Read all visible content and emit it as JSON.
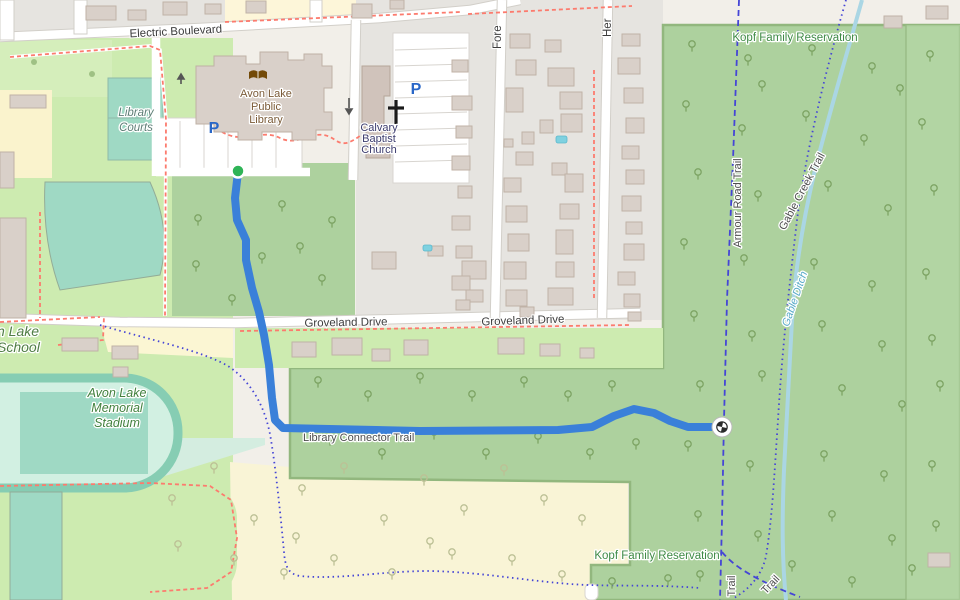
{
  "map": {
    "type": "openstreetmap-style trail route view",
    "labels": {
      "electric_boulevard": "Electric Boulevard",
      "fore_street": "Fore",
      "her_street": "Her",
      "kopf_reservation_top": "Kopf Family Reservation",
      "kopf_reservation_bottom": "Kopf Family Reservation",
      "library": [
        "Avon Lake",
        "Public",
        "Library"
      ],
      "church": [
        "Calvary",
        "Baptist",
        "Church"
      ],
      "groveland_west": "Groveland Drive",
      "groveland_east": "Groveland Drive",
      "school": [
        "n Lake",
        "School"
      ],
      "stadium": [
        "Avon Lake",
        "Memorial",
        "Stadium"
      ],
      "library_courts": [
        "Library",
        "Courts"
      ],
      "library_connector_trail": "Library Connector Trail",
      "armour_road_trail": "Armour Road Trail",
      "gable_creek_trail": "Gable Creek Trail",
      "gable_ditch": "Gable Ditch",
      "trail_vertical": "Trail",
      "trail_diagonal": "Trail",
      "parking_glyph": "P"
    },
    "colors": {
      "route": "#3a80d9",
      "route_start_marker": "#2fb457",
      "trail_blue": "#4545d6",
      "forest_green": "#add19e",
      "grass_green": "#cdebb0",
      "pitch_teal": "#9fd9c4",
      "scrub_yellow": "#f9f4d6",
      "water_blue": "#aad6e4",
      "residential_gray": "#e6e4e0",
      "building_tan": "#d9d0c9",
      "path_red": "#fc7b6e"
    }
  },
  "route": {
    "name": "Library Connector Trail route",
    "color": "#3a80d9",
    "points": [
      [
        238,
        172
      ],
      [
        235,
        198
      ],
      [
        237,
        220
      ],
      [
        246,
        240
      ],
      [
        246,
        260
      ],
      [
        252,
        288
      ],
      [
        259,
        312
      ],
      [
        264,
        335
      ],
      [
        269,
        365
      ],
      [
        272,
        398
      ],
      [
        275,
        420
      ],
      [
        283,
        428
      ],
      [
        420,
        431
      ],
      [
        558,
        430
      ],
      [
        592,
        427
      ],
      [
        614,
        416
      ],
      [
        634,
        409
      ],
      [
        654,
        413
      ],
      [
        670,
        421
      ],
      [
        688,
        427
      ],
      [
        722,
        427
      ]
    ],
    "start": {
      "x": 238,
      "y": 171,
      "icon": "green-dot-start-marker"
    },
    "end": {
      "x": 722,
      "y": 427,
      "icon": "checkered-finish-marker"
    }
  },
  "decor": {
    "houses": [
      [
        86,
        6,
        30,
        14
      ],
      [
        128,
        10,
        18,
        10
      ],
      [
        163,
        2,
        24,
        13
      ],
      [
        205,
        4,
        16,
        10
      ],
      [
        246,
        1,
        20,
        12
      ],
      [
        352,
        4,
        20,
        14
      ],
      [
        390,
        0,
        14,
        9
      ],
      [
        884,
        16,
        18,
        12
      ],
      [
        926,
        6,
        22,
        13
      ],
      [
        928,
        553,
        22,
        14
      ],
      [
        0,
        218,
        26,
        100
      ],
      [
        10,
        95,
        36,
        13
      ],
      [
        0,
        152,
        14,
        36
      ],
      [
        62,
        338,
        36,
        13
      ],
      [
        112,
        346,
        26,
        13
      ],
      [
        113,
        367,
        15,
        10
      ],
      [
        292,
        342,
        24,
        15
      ],
      [
        332,
        338,
        30,
        17
      ],
      [
        372,
        349,
        18,
        12
      ],
      [
        404,
        340,
        24,
        15
      ],
      [
        498,
        338,
        26,
        16
      ],
      [
        540,
        344,
        20,
        12
      ],
      [
        580,
        348,
        14,
        10
      ],
      [
        372,
        252,
        24,
        17
      ],
      [
        428,
        246,
        15,
        10
      ],
      [
        462,
        261,
        24,
        18
      ],
      [
        466,
        290,
        17,
        12
      ],
      [
        452,
        60,
        16,
        12
      ],
      [
        452,
        96,
        20,
        14
      ],
      [
        456,
        126,
        16,
        12
      ],
      [
        452,
        156,
        18,
        14
      ],
      [
        458,
        186,
        14,
        12
      ],
      [
        452,
        216,
        18,
        14
      ],
      [
        456,
        246,
        16,
        12
      ],
      [
        452,
        276,
        18,
        14
      ],
      [
        456,
        300,
        14,
        10
      ],
      [
        510,
        34,
        20,
        14
      ],
      [
        545,
        40,
        16,
        12
      ],
      [
        516,
        60,
        20,
        15
      ],
      [
        548,
        68,
        26,
        18
      ],
      [
        506,
        88,
        17,
        24
      ],
      [
        560,
        92,
        22,
        17
      ],
      [
        561,
        114,
        21,
        18
      ],
      [
        540,
        120,
        13,
        13
      ],
      [
        522,
        132,
        12,
        12
      ],
      [
        504,
        139,
        9,
        8
      ],
      [
        516,
        152,
        17,
        13
      ],
      [
        552,
        163,
        15,
        12
      ],
      [
        504,
        178,
        17,
        14
      ],
      [
        565,
        174,
        18,
        18
      ],
      [
        506,
        206,
        21,
        16
      ],
      [
        560,
        204,
        19,
        15
      ],
      [
        508,
        234,
        21,
        17
      ],
      [
        556,
        230,
        17,
        24
      ],
      [
        504,
        262,
        22,
        17
      ],
      [
        556,
        262,
        18,
        15
      ],
      [
        506,
        290,
        21,
        16
      ],
      [
        548,
        288,
        25,
        17
      ],
      [
        520,
        307,
        14,
        10
      ],
      [
        622,
        34,
        18,
        12
      ],
      [
        618,
        58,
        22,
        16
      ],
      [
        624,
        88,
        19,
        15
      ],
      [
        626,
        118,
        18,
        15
      ],
      [
        622,
        146,
        17,
        13
      ],
      [
        626,
        170,
        18,
        14
      ],
      [
        622,
        196,
        19,
        15
      ],
      [
        626,
        222,
        16,
        12
      ],
      [
        624,
        244,
        20,
        16
      ],
      [
        618,
        272,
        17,
        13
      ],
      [
        624,
        294,
        16,
        13
      ],
      [
        628,
        312,
        13,
        9
      ]
    ],
    "pools": [
      [
        556,
        136,
        11,
        7
      ],
      [
        423,
        245,
        9,
        6
      ]
    ],
    "trees_green": [
      [
        692,
        48
      ],
      [
        748,
        62
      ],
      [
        812,
        52
      ],
      [
        872,
        70
      ],
      [
        930,
        58
      ],
      [
        686,
        108
      ],
      [
        742,
        132
      ],
      [
        806,
        118
      ],
      [
        864,
        142
      ],
      [
        922,
        126
      ],
      [
        698,
        176
      ],
      [
        758,
        198
      ],
      [
        828,
        188
      ],
      [
        888,
        212
      ],
      [
        934,
        192
      ],
      [
        684,
        246
      ],
      [
        744,
        262
      ],
      [
        814,
        266
      ],
      [
        872,
        288
      ],
      [
        926,
        276
      ],
      [
        694,
        318
      ],
      [
        752,
        338
      ],
      [
        822,
        328
      ],
      [
        882,
        348
      ],
      [
        932,
        342
      ],
      [
        700,
        388
      ],
      [
        762,
        378
      ],
      [
        842,
        392
      ],
      [
        902,
        408
      ],
      [
        940,
        388
      ],
      [
        688,
        448
      ],
      [
        750,
        468
      ],
      [
        824,
        458
      ],
      [
        884,
        478
      ],
      [
        932,
        468
      ],
      [
        698,
        518
      ],
      [
        758,
        538
      ],
      [
        832,
        518
      ],
      [
        892,
        542
      ],
      [
        936,
        528
      ],
      [
        700,
        578
      ],
      [
        792,
        568
      ],
      [
        852,
        584
      ],
      [
        912,
        572
      ],
      [
        900,
        92
      ],
      [
        762,
        88
      ],
      [
        318,
        384
      ],
      [
        368,
        398
      ],
      [
        420,
        380
      ],
      [
        472,
        398
      ],
      [
        524,
        384
      ],
      [
        568,
        398
      ],
      [
        612,
        388
      ],
      [
        330,
        442
      ],
      [
        382,
        456
      ],
      [
        434,
        436
      ],
      [
        486,
        456
      ],
      [
        538,
        440
      ],
      [
        590,
        456
      ],
      [
        636,
        446
      ],
      [
        198,
        222
      ],
      [
        282,
        208
      ],
      [
        332,
        224
      ],
      [
        196,
        268
      ],
      [
        262,
        260
      ],
      [
        322,
        282
      ],
      [
        232,
        302
      ],
      [
        300,
        250
      ],
      [
        612,
        585
      ],
      [
        668,
        582
      ]
    ],
    "trees_pale": [
      [
        172,
        502
      ],
      [
        214,
        470
      ],
      [
        254,
        522
      ],
      [
        302,
        492
      ],
      [
        344,
        470
      ],
      [
        384,
        522
      ],
      [
        424,
        482
      ],
      [
        464,
        512
      ],
      [
        504,
        472
      ],
      [
        544,
        502
      ],
      [
        582,
        522
      ],
      [
        334,
        562
      ],
      [
        392,
        576
      ],
      [
        452,
        556
      ],
      [
        512,
        562
      ],
      [
        562,
        578
      ],
      [
        234,
        562
      ],
      [
        284,
        576
      ],
      [
        178,
        548
      ],
      [
        296,
        540
      ],
      [
        430,
        545
      ]
    ],
    "lawn_dots": [
      [
        34,
        62
      ],
      [
        92,
        74
      ]
    ]
  }
}
